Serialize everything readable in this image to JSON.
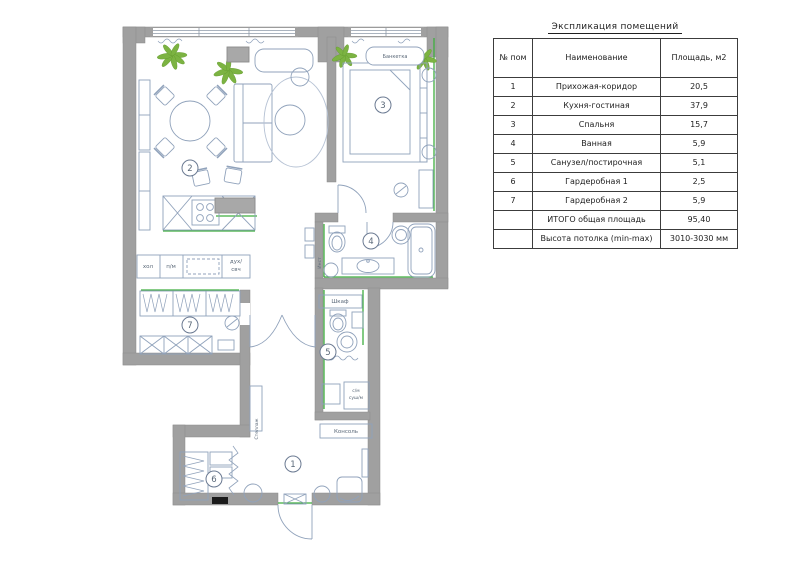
{
  "table": {
    "title": "Экспликация помещений",
    "headers": {
      "num": "№ пом",
      "name": "Наименование",
      "area": "Площадь, м2"
    },
    "rows": [
      {
        "num": "1",
        "name": "Прихожая-коридор",
        "area": "20,5"
      },
      {
        "num": "2",
        "name": "Кухня-гостиная",
        "area": "37,9"
      },
      {
        "num": "3",
        "name": "Спальня",
        "area": "15,7"
      },
      {
        "num": "4",
        "name": "Ванная",
        "area": "5,9"
      },
      {
        "num": "5",
        "name": "Санузел/постирочная",
        "area": "5,1"
      },
      {
        "num": "6",
        "name": "Гардеробная 1",
        "area": "2,5"
      },
      {
        "num": "7",
        "name": "Гардеробная 2",
        "area": "5,9"
      }
    ],
    "total": {
      "label": "ИТОГО общая площадь",
      "value": "95,40"
    },
    "ceiling": {
      "label": "Высота потолка (min-max)",
      "value": "3010-3030 мм"
    }
  },
  "plan": {
    "room_numbers": [
      "1",
      "2",
      "3",
      "4",
      "5",
      "6",
      "7"
    ],
    "labels": {
      "fridge": "хол",
      "dishwasher": "п/м",
      "oven_top": "дух/",
      "oven_bottom": "свч",
      "closet": "Шкаф",
      "installation": "Инст",
      "washer": "с/м",
      "dryer": "суш/м",
      "console": "Консоль",
      "shelving": "Стеллаж",
      "bench": "Банкетка"
    }
  },
  "colors": {
    "wall": "#a0a0a0",
    "furniture_line": "#90a2bb",
    "accent_green": "#3fae3f",
    "plant_green": "#7cb342",
    "table_border": "#3c3c3c"
  }
}
